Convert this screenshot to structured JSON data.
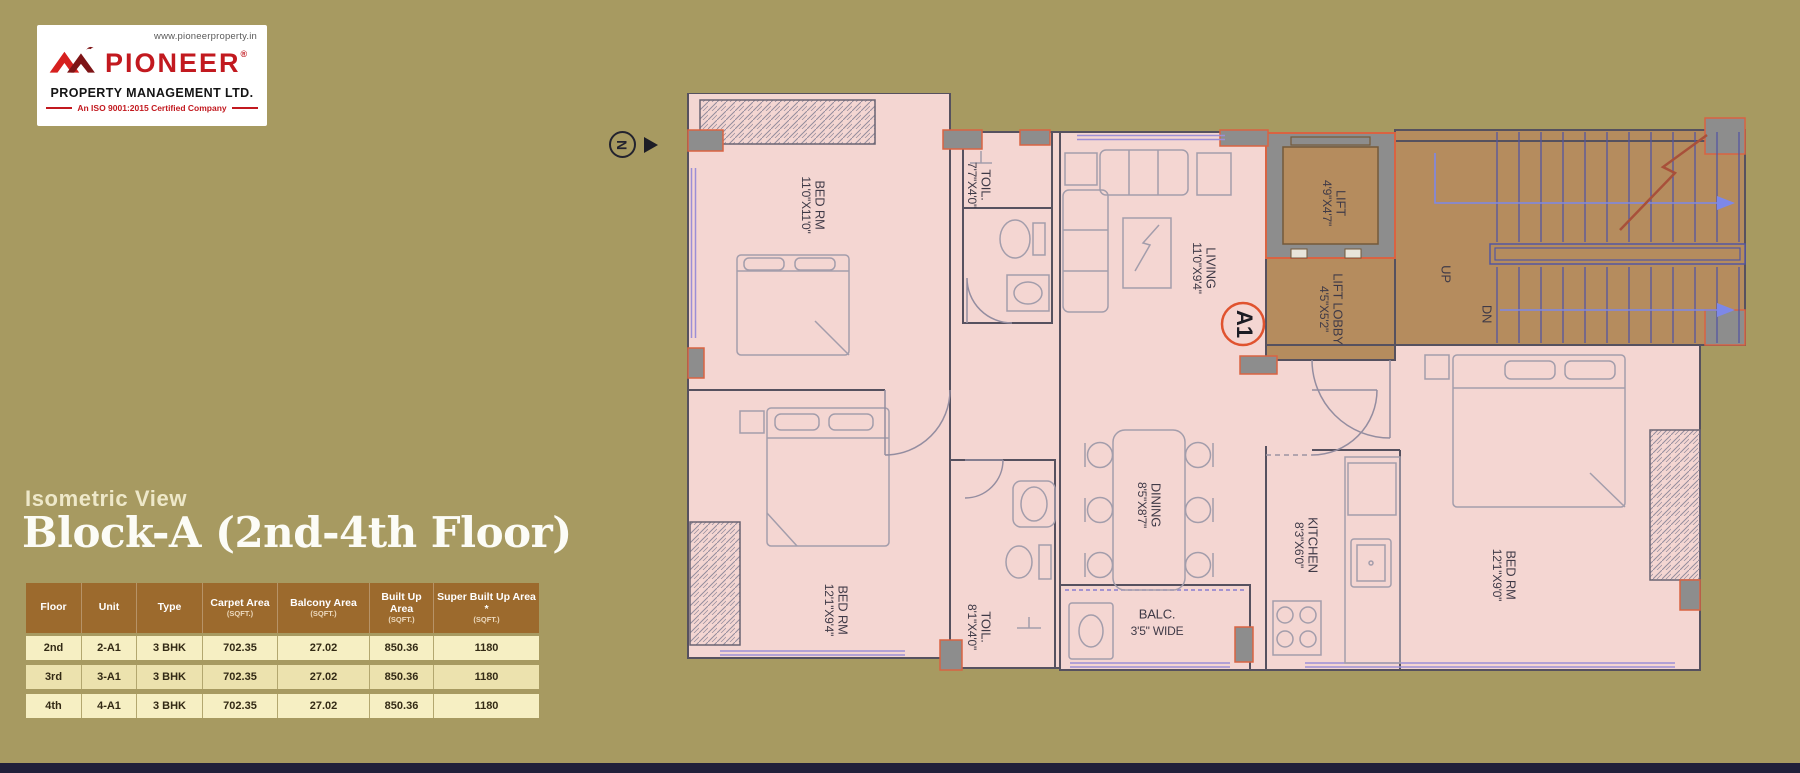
{
  "colors": {
    "background_olive": "#a79a61",
    "brand_red": "#c2191f",
    "plan_pink": "#f4d6d2",
    "stair_brown": "#b58c5e",
    "table_header_brown": "#9c6a2d",
    "table_row_cream": "#f6efc3",
    "column_outline_orange": "#d96342",
    "footer_navy": "#20203a"
  },
  "logo": {
    "website": "www.pioneerproperty.in",
    "brand": "PIONEER",
    "registered": "®",
    "subtitle": "PROPERTY MANAGEMENT LTD.",
    "iso": "An ISO 9001:2015 Certified Company"
  },
  "heading": {
    "eyebrow": "Isometric View",
    "title": "Block-A (2nd-4th Floor)"
  },
  "table": {
    "columns": [
      {
        "label": "Floor",
        "unit": ""
      },
      {
        "label": "Unit",
        "unit": ""
      },
      {
        "label": "Type",
        "unit": ""
      },
      {
        "label": "Carpet Area",
        "unit": "(SQFT.)"
      },
      {
        "label": "Balcony Area",
        "unit": "(SQFT.)"
      },
      {
        "label": "Built Up Area",
        "unit": "(SQFT.)"
      },
      {
        "label": "Super Built Up Area *",
        "unit": "(SQFT.)"
      }
    ],
    "rows": [
      {
        "floor": "2nd",
        "unit": "2-A1",
        "type": "3 BHK",
        "carpet": "702.35",
        "balcony": "27.02",
        "built_up": "850.36",
        "super_built_up": "1180"
      },
      {
        "floor": "3rd",
        "unit": "3-A1",
        "type": "3 BHK",
        "carpet": "702.35",
        "balcony": "27.02",
        "built_up": "850.36",
        "super_built_up": "1180"
      },
      {
        "floor": "4th",
        "unit": "4-A1",
        "type": "3 BHK",
        "carpet": "702.35",
        "balcony": "27.02",
        "built_up": "850.36",
        "super_built_up": "1180"
      }
    ]
  },
  "floor_plan": {
    "north_label": "N",
    "unit_badge": "A1",
    "stairs": {
      "up": "UP",
      "dn": "DN"
    },
    "balcony": {
      "name": "BALC.",
      "dims": "3'5\" WIDE"
    },
    "rooms": [
      {
        "name": "BED RM",
        "dims": "11'0\"X11'0\""
      },
      {
        "name": "TOIL.",
        "dims": "7'7\"X4'0\""
      },
      {
        "name": "LIVING",
        "dims": "11'0\"X9'4\""
      },
      {
        "name": "LIFT",
        "dims": "4'9\"X4'7\""
      },
      {
        "name": "LIFT LOBBY",
        "dims": "4'5\"X5'2\""
      },
      {
        "name": "DINING",
        "dims": "8'5\"X8'7\""
      },
      {
        "name": "KITCHEN",
        "dims": "8'3\"X6'0\""
      },
      {
        "name": "BED RM",
        "dims": "12'1\"X9'4\""
      },
      {
        "name": "BED RM",
        "dims": "12'1\"X9'0\""
      },
      {
        "name": "TOIL.",
        "dims": "8'1\"X4'0\""
      }
    ]
  }
}
